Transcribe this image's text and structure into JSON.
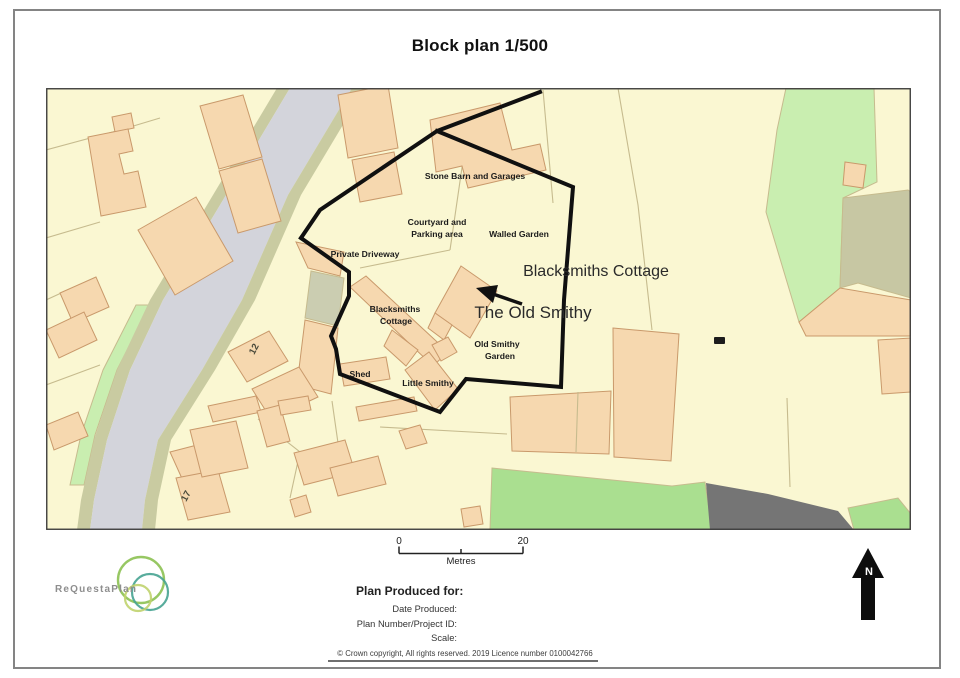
{
  "page": {
    "title": "Block plan 1/500"
  },
  "map": {
    "labels": {
      "stone_barn": "Stone Barn and Garages",
      "courtyard_line1": "Courtyard and",
      "courtyard_line2": "Parking area",
      "walled_garden": "Walled Garden",
      "private_driveway": "Private Driveway",
      "blacksmiths_small_line1": "Blacksmiths",
      "blacksmiths_small_line2": "Cottage",
      "blacksmiths_large": "Blacksmiths Cottage",
      "old_smithy_large": "The Old Smithy",
      "old_smithy_garden_line1": "Old Smithy",
      "old_smithy_garden_line2": "Garden",
      "shed": "Shed",
      "little_smithy": "Little Smithy",
      "plot_number_12": "12",
      "plot_number_17": "17"
    }
  },
  "scale_bar": {
    "zero": "0",
    "twenty": "20",
    "unit": "Metres"
  },
  "north_arrow": {
    "label": "N"
  },
  "logo": {
    "text": "ReQuestaPlan"
  },
  "footer": {
    "produced_for": "Plan Produced for:",
    "date_produced": "Date Produced:",
    "plan_number": "Plan Number/Project ID:",
    "scale": "Scale:",
    "copyright": "© Crown copyright, All rights reserved. 2019 Licence number 0100042766"
  },
  "theme": {
    "cream": "#FAF7D2",
    "building": "#F6D8AF",
    "bstroke": "#C9996B",
    "road": "#D3D4DB",
    "verge": "#C9CBA1",
    "green1": "#C9EEB0",
    "green2": "#AADF90",
    "olive": "#C7C7A3",
    "olive2": "#CBCDB1",
    "dgray": "#757575",
    "parcel": "#C6BB8E",
    "boundary": "#101010",
    "label": "#1b1b1b",
    "biglabel": "#2a2a2a"
  }
}
